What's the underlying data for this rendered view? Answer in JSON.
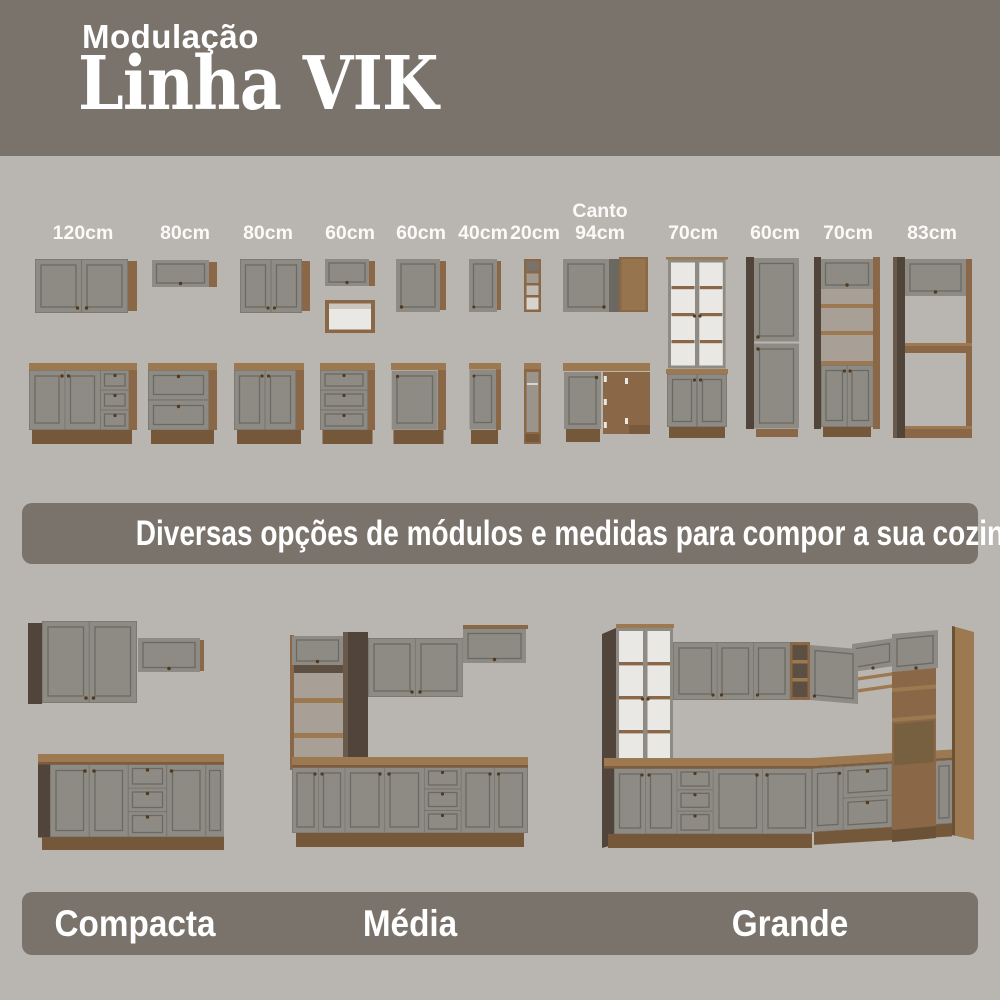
{
  "header": {
    "kicker": "Modulação",
    "title": "Linha VIK"
  },
  "modules": {
    "items": [
      {
        "size": "120cm"
      },
      {
        "size": "80cm"
      },
      {
        "size": "80cm"
      },
      {
        "size": "60cm"
      },
      {
        "size": "60cm"
      },
      {
        "size": "40cm"
      },
      {
        "size": "20cm"
      },
      {
        "prefix": "Canto",
        "size": "94cm"
      },
      {
        "size": "70cm"
      },
      {
        "size": "60cm"
      },
      {
        "size": "70cm"
      },
      {
        "size": "83cm"
      }
    ]
  },
  "banner": {
    "text": "Diversas opções de módulos e medidas para compor a sua cozinha!"
  },
  "layouts": {
    "items": [
      {
        "label": "Compacta"
      },
      {
        "label": "Média"
      },
      {
        "label": "Grande"
      }
    ]
  },
  "colors": {
    "band": "#7a736c",
    "background": "#b9b5b0",
    "cabinet_gray": "#8e8b85",
    "wood": "#8a6847",
    "wood_light": "#9c7950",
    "wood_dark": "#755839",
    "dark_side": "#51453b",
    "glass_white": "#eae8e4",
    "text": "#ffffff"
  }
}
